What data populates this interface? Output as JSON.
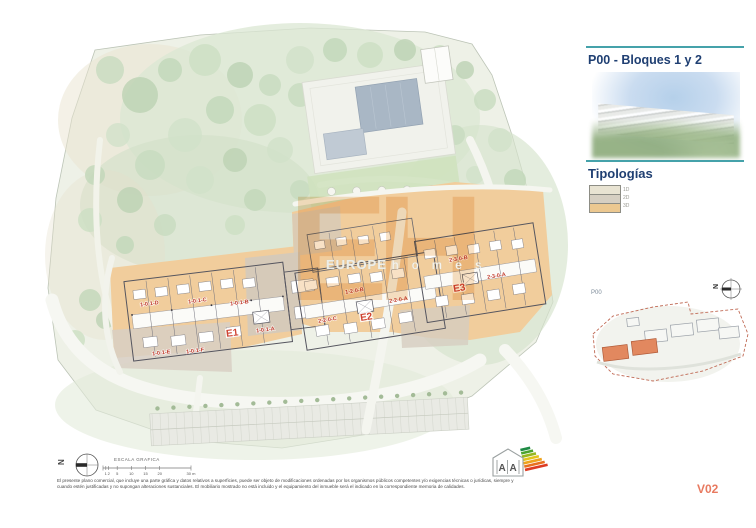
{
  "sidebar": {
    "title": "P00 - Bloques 1 y 2",
    "tipologias_heading": "Tipologías",
    "legend": [
      {
        "label": "1D",
        "color": "#e8e3d2"
      },
      {
        "label": "2D",
        "color": "#d6cfc2"
      },
      {
        "label": "3D",
        "color": "#ecc890"
      }
    ],
    "minimap": {
      "label": "P00",
      "north_label": "N"
    }
  },
  "plan": {
    "watermark": {
      "initials": "EH",
      "brand": "EUROPE",
      "brand_suffix": "h o m e s"
    },
    "blocks": [
      {
        "id": "E1",
        "units": [
          "1-0-1-D",
          "1-0-1-C",
          "1-0-1-B",
          "1-0-1-A",
          "1-0-1-E",
          "1-0-1-F"
        ]
      },
      {
        "id": "E2",
        "units": [
          "1-2-0-B",
          "2-2-0-A",
          "2-2-0-C"
        ]
      },
      {
        "id": "E3",
        "units": [
          "2-3-0-B",
          "2-3-0-A"
        ]
      }
    ]
  },
  "footer": {
    "north_label": "N",
    "scale_title": "ESCALA GRAFICA",
    "scale_ticks": [
      "1",
      "2",
      "5",
      "10",
      "15",
      "20"
    ],
    "scale_end_label": "30 m",
    "disclaimer_line1": "El presente plano comercial, que incluye una parte gráfica y datos relativos a superficies, puede ser objeto de modificaciones ordenadas por los organismos públicos competentes y/o exigencias técnicas o jurídicas, siempre y",
    "disclaimer_line2": "cuando estén justificadas y no supongan alteraciones sustanciales. El mobiliario mostrado no está incluido y el equipamiento del inmueble será el indicado en la correspondiente memoria de calidades.",
    "energy_rating": {
      "letter_left": "A",
      "letter_right": "A"
    },
    "version": "V02"
  },
  "colors": {
    "accent_teal": "#45a2aa",
    "title_navy": "#1f3f72",
    "unit_label_red": "#c03a2b",
    "version_color": "#e87a60",
    "building_tan": "#f1cd9c",
    "building_taupe": "#d3cabd",
    "minimap_highlight": "#e2885f"
  }
}
